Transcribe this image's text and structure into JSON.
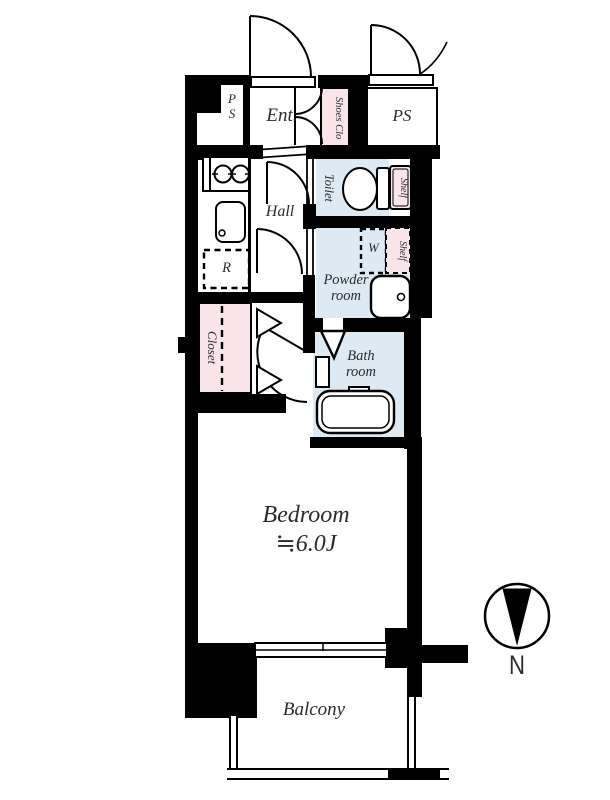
{
  "colors": {
    "wall": "#000000",
    "wet_area_fill": "#dde9f3",
    "storage_fill": "#f9e4ea",
    "label_text": "#2b2b2b"
  },
  "labels": {
    "ps_shaft_small": "P\nS",
    "entrance": "Ent.",
    "shoes_closet": "Shoes Clo",
    "pipe_space": "PS",
    "toilet": "Toilet",
    "toilet_shelf": "Shelf",
    "hall": "Hall",
    "refrigerator_space": "R",
    "powder_room": "Powder\nroom",
    "washer_space": "W",
    "powder_shelf": "Shelf",
    "closet": "Closet",
    "bath_room": "Bath\nroom",
    "bedroom_name": "Bedroom",
    "bedroom_size": "≒6.0J",
    "balcony": "Balcony",
    "compass_north": "N"
  }
}
